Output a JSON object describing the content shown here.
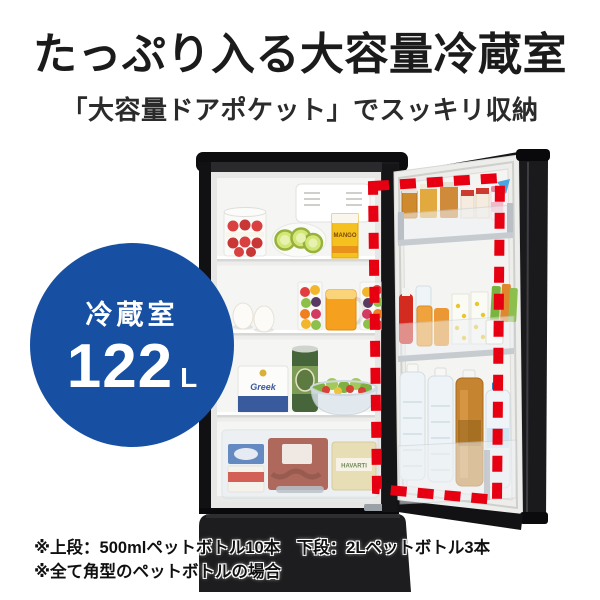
{
  "header": {
    "title": "たっぷり入る大容量冷蔵室",
    "subtitle": "「大容量ドアポケット」でスッキリ収納"
  },
  "capacity_badge": {
    "label": "冷蔵室",
    "value": "122",
    "unit": "L",
    "bg_color": "#1750a3",
    "text_color": "#ffffff"
  },
  "door_pocket_highlight": {
    "color": "#e60012",
    "style": "dashed"
  },
  "footnotes": [
    "※上段：500mlペットボトル10本　下段：2Lペットボトル3本",
    "※全て角型のペットボトルの場合"
  ],
  "fridge": {
    "labels": {
      "mango_carton": "MANGO",
      "yogurt_tub": "Greek",
      "cheese_block": "HAVARTI"
    }
  }
}
